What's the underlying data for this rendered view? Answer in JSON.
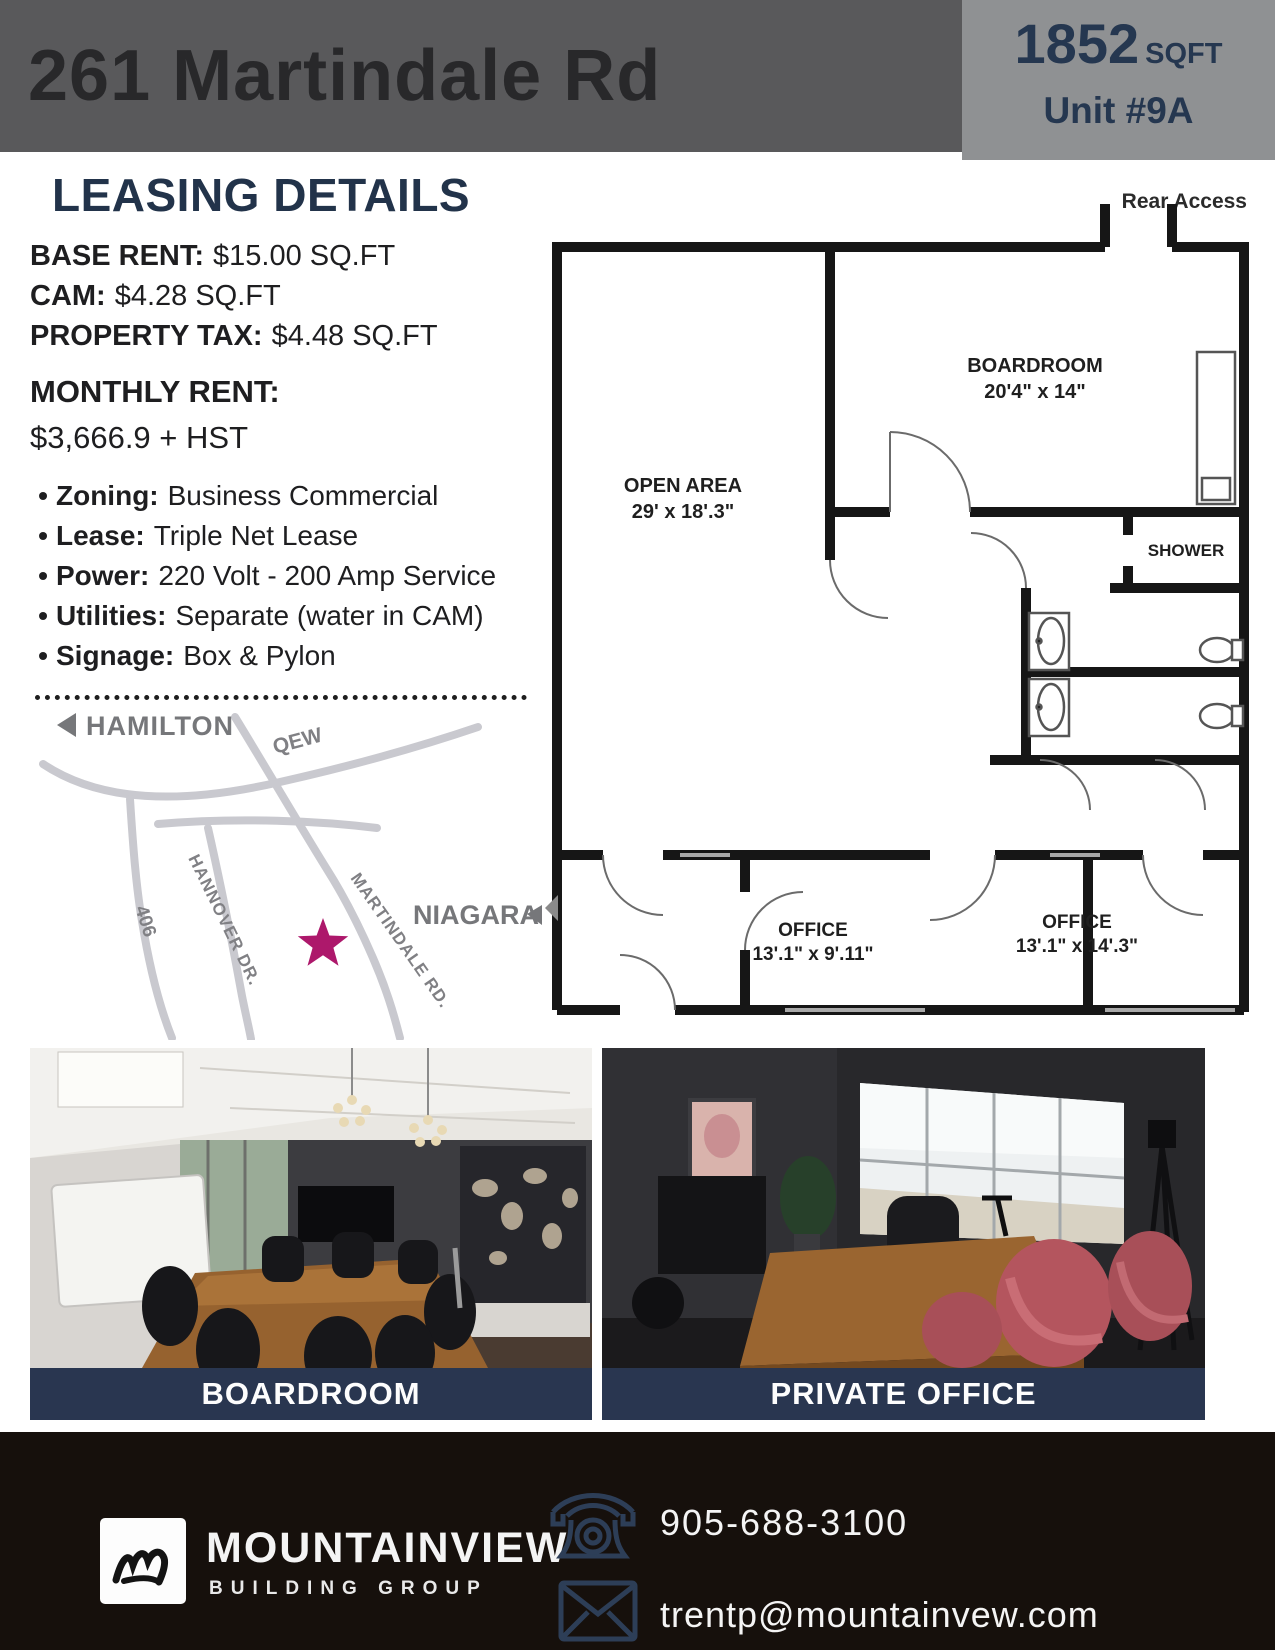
{
  "header": {
    "address": "261 Martindale Rd",
    "sqft_value": "1852",
    "sqft_label": "SQFT",
    "unit": "Unit #9A"
  },
  "leasing": {
    "title": "LEASING DETAILS",
    "lines": [
      {
        "label": "BASE RENT:",
        "value": "$15.00 SQ.FT"
      },
      {
        "label": "CAM:",
        "value": "$4.28 SQ.FT"
      },
      {
        "label": "PROPERTY TAX:",
        "value": "$4.48 SQ.FT"
      }
    ],
    "monthly_label": "MONTHLY RENT:",
    "monthly_value": "$3,666.9 + HST",
    "bullets": [
      {
        "label": "Zoning:",
        "value": "Business Commercial"
      },
      {
        "label": "Lease:",
        "value": "Triple Net Lease"
      },
      {
        "label": "Power:",
        "value": "220 Volt - 200 Amp Service"
      },
      {
        "label": "Utilities:",
        "value": "Separate (water in CAM)"
      },
      {
        "label": "Signage:",
        "value": "Box & Pylon"
      }
    ]
  },
  "map": {
    "hamilton": "HAMILTON",
    "niagara": "NIAGARA",
    "qew": "QEW",
    "r406": "406",
    "hannover": "HANNOVER DR.",
    "martindale": "MARTINDALE RD.",
    "star_icon": "location-star",
    "star_color": "#ad186b",
    "road_color": "#c9c9cf",
    "label_color": "#808084"
  },
  "floorplan": {
    "rear_access": "Rear Access",
    "open_area_name": "OPEN AREA",
    "open_area_dims": "29' x 18'.3\"",
    "boardroom_name": "BOARDROOM",
    "boardroom_dims": "20'4\" x 14\"",
    "shower": "SHOWER",
    "office1_name": "OFFICE",
    "office1_dims": "13'.1\" x 9'.11\"",
    "office2_name": "OFFICE",
    "office2_dims": "13'.1\" x 14'.3\""
  },
  "photos": {
    "left_caption": "BOARDROOM",
    "right_caption": "PRIVATE OFFICE"
  },
  "footer": {
    "brand": "MOUNTAINVIEW",
    "brand_sub": "BUILDING GROUP",
    "phone": "905-688-3100",
    "email": "trentp@mountainvew.com",
    "phone_icon": "phone-icon",
    "email_icon": "envelope-icon"
  },
  "colors": {
    "header_band": "#59595b",
    "header_box": "#8f9193",
    "navy": "#22334a",
    "caption_bar": "#293650",
    "footer_bg": "#16100c",
    "accent_star": "#ad186b"
  }
}
